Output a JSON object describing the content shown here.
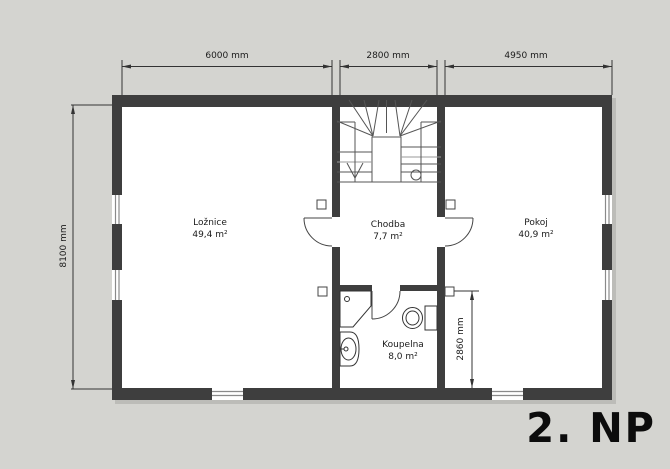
{
  "plan": {
    "title": "2. NP",
    "rooms": {
      "loznice": {
        "name": "Ložnice",
        "area": "49,4 m²"
      },
      "chodba": {
        "name": "Chodba",
        "area": "7,7 m²"
      },
      "pokoj": {
        "name": "Pokoj",
        "area": "40,9 m²"
      },
      "koupelna": {
        "name": "Koupelna",
        "area": "8,0 m²"
      }
    },
    "dimensions": {
      "top_left": "6000 mm",
      "top_middle": "2800 mm",
      "top_right": "4950 mm",
      "left_side": "8100 mm",
      "bathroom_depth": "2860 mm"
    },
    "symbols": {
      "stairs": "u-shaped-winder-staircase",
      "fixtures": [
        "shower",
        "sink",
        "toilet"
      ],
      "wall_markers": 4
    },
    "colors": {
      "background": "#d4d4d0",
      "wall": "#3e3e3e",
      "floor": "#ffffff",
      "line": "#444444",
      "dimension": "#333333",
      "title_text": "#0c0c0c"
    }
  }
}
